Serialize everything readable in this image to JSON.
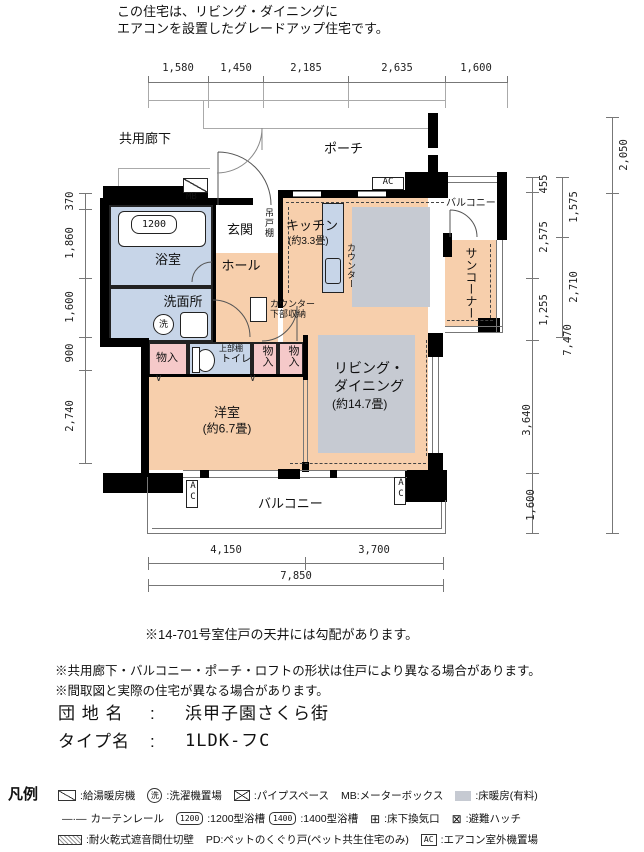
{
  "header": {
    "line1": "この住宅は、リビング・ダイニングに",
    "line2": "エアコンを設置したグレードアップ住宅です。"
  },
  "plan": {
    "corridor": "共用廊下",
    "porch": "ポーチ",
    "mb": "MB",
    "ac": "AC",
    "rooms": {
      "bathroom": {
        "label": "浴室",
        "tub": "1200"
      },
      "entrance": "玄関",
      "hall": "ホール",
      "washroom": "洗面所",
      "washer_glyph": "洗",
      "hanging_cabinet": "吊戸棚",
      "kitchen": {
        "label": "キッチン",
        "size": "(約3.3畳)"
      },
      "counter": "カウンター",
      "counter_storage": "カウンター下部収納",
      "living": {
        "line1": "リビング・",
        "line2": "ダイニング",
        "size": "(約14.7畳)"
      },
      "western": {
        "label": "洋室",
        "size": "(約6.7畳)"
      },
      "closet1": "物入",
      "closet2": "物入",
      "closet3": "物入",
      "toilet": {
        "shelf": "上部棚",
        "label": "トイレ"
      },
      "sun_corner": "サンコーナー",
      "balcony_upper": "バルコニー",
      "balcony_bottom": "バルコニー",
      "fold_mark": "∨"
    },
    "dims": {
      "top": [
        "1,580",
        "1,450",
        "2,185",
        "2,635",
        "1,600"
      ],
      "left": [
        "370",
        "1,860",
        "1,600",
        "900",
        "2,740"
      ],
      "right_inner": [
        "455",
        "2,575",
        "1,255",
        "3,640",
        "1,600"
      ],
      "right_mid": [
        "1,575",
        "2,710",
        "7,470"
      ],
      "right_outer": [
        "2,050"
      ],
      "bottom_upper": [
        "4,150",
        "3,700"
      ],
      "bottom_total": "7,850"
    },
    "note_ceiling": "※14-701号室住戸の天井には勾配があります。"
  },
  "notes": {
    "line1": "※共用廊下・バルコニー・ポーチ・ロフトの形状は住戸により異なる場合があります。",
    "line2": "※間取図と実際の住宅が異なる場合があります。"
  },
  "info": {
    "estate_label": "団 地 名",
    "estate_sep": ":",
    "estate_value": "浜甲子園さくら街",
    "type_label": "タイプ名",
    "type_sep": ":",
    "type_value": "1LDK-フC"
  },
  "legend": {
    "title": "凡例",
    "water_heater": ":給湯暖房機",
    "washer_glyph": "洗",
    "washer": ":洗濯機置場",
    "pipe_space": ":パイプスペース",
    "mb": "MB:メーターボックス",
    "floor_heating": ":床暖房(有料)",
    "curtain_rail_glyph": "—·—",
    "curtain_rail": "カーテンレール",
    "tub1200_glyph": "1200",
    "tub1200": ":1200型浴槽",
    "tub1400_glyph": "1400",
    "tub1400": ":1400型浴槽",
    "vent_glyph": "⊞",
    "vent": ":床下換気口",
    "hatch_glyph": "⊠",
    "hatch": ":避難ハッチ",
    "firewall": ":耐火乾式遮音間仕切壁",
    "pd": "PD:ペットのくぐり戸(ペット共生住宅のみ)",
    "ac_glyph": "AC",
    "ac": ":エアコン室外機置場"
  }
}
